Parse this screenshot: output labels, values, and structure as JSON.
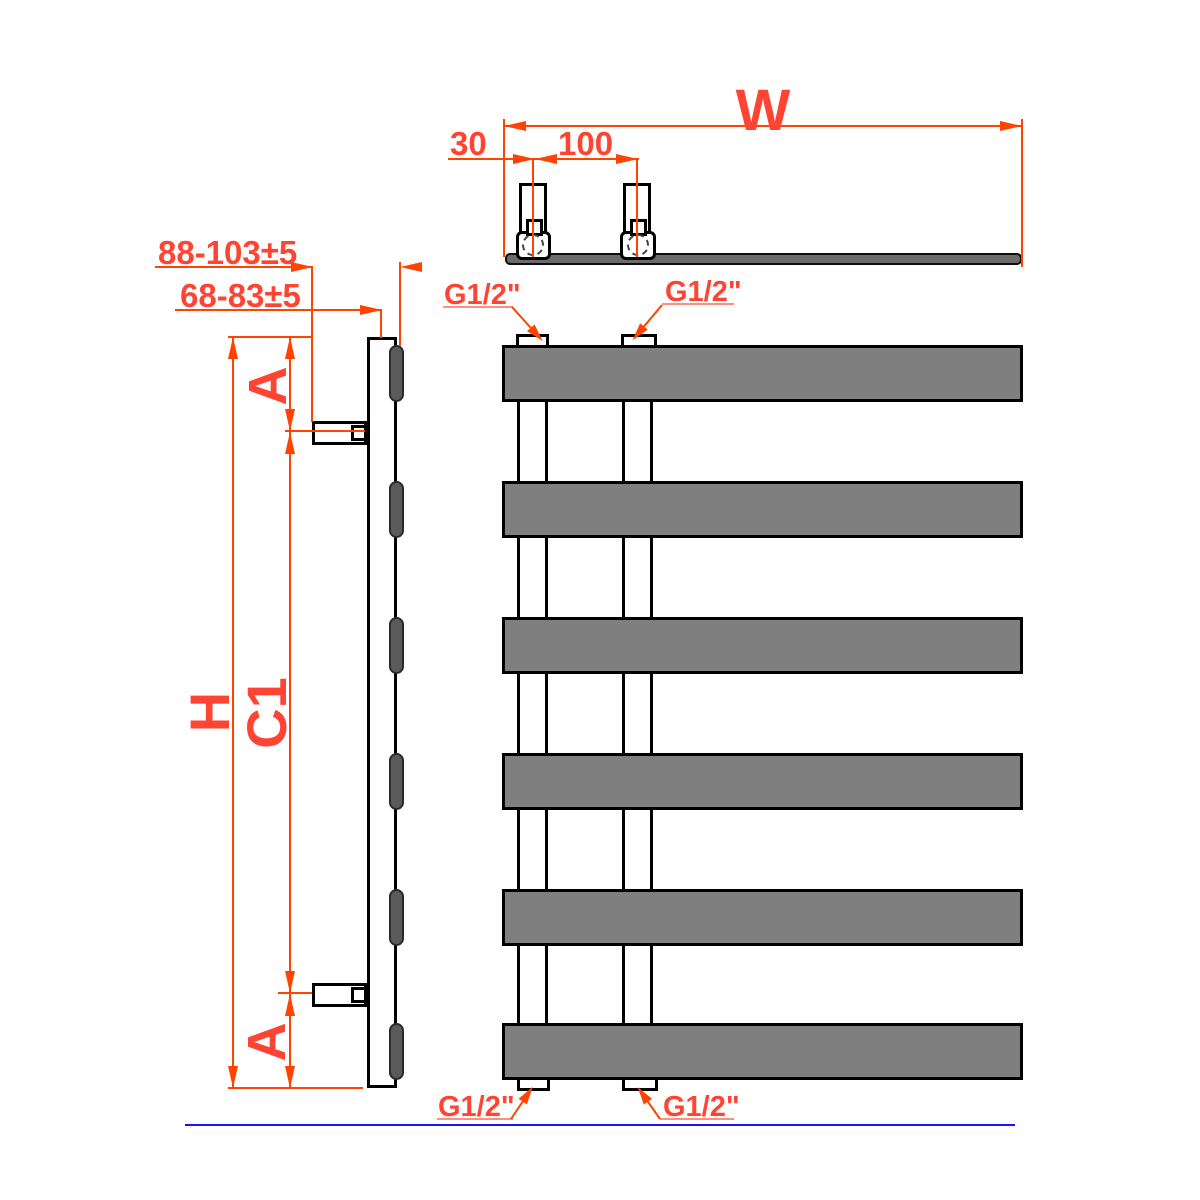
{
  "labels": {
    "width": "W",
    "offset_30": "30",
    "spacing_100": "100",
    "wall_distance_outer": "88-103±5",
    "wall_distance_inner": "68-83±5",
    "connection": "G1/2\"",
    "height": "H",
    "bracket_span": "C1",
    "edge_offset_top": "A",
    "edge_offset_bottom": "A"
  },
  "colors": {
    "dimension_red": "#ff4300",
    "bar_fill": "#7f7f7f",
    "slab_fill": "#6b6b6b",
    "side_profile_fill": "#5a5a5a",
    "ground_line_blue": "#1414ff",
    "outline_black": "#000000"
  },
  "structure": {
    "bar_count": 6,
    "riser_pipe_count": 2,
    "wall_bracket_count": 2,
    "connection_count": 4
  }
}
